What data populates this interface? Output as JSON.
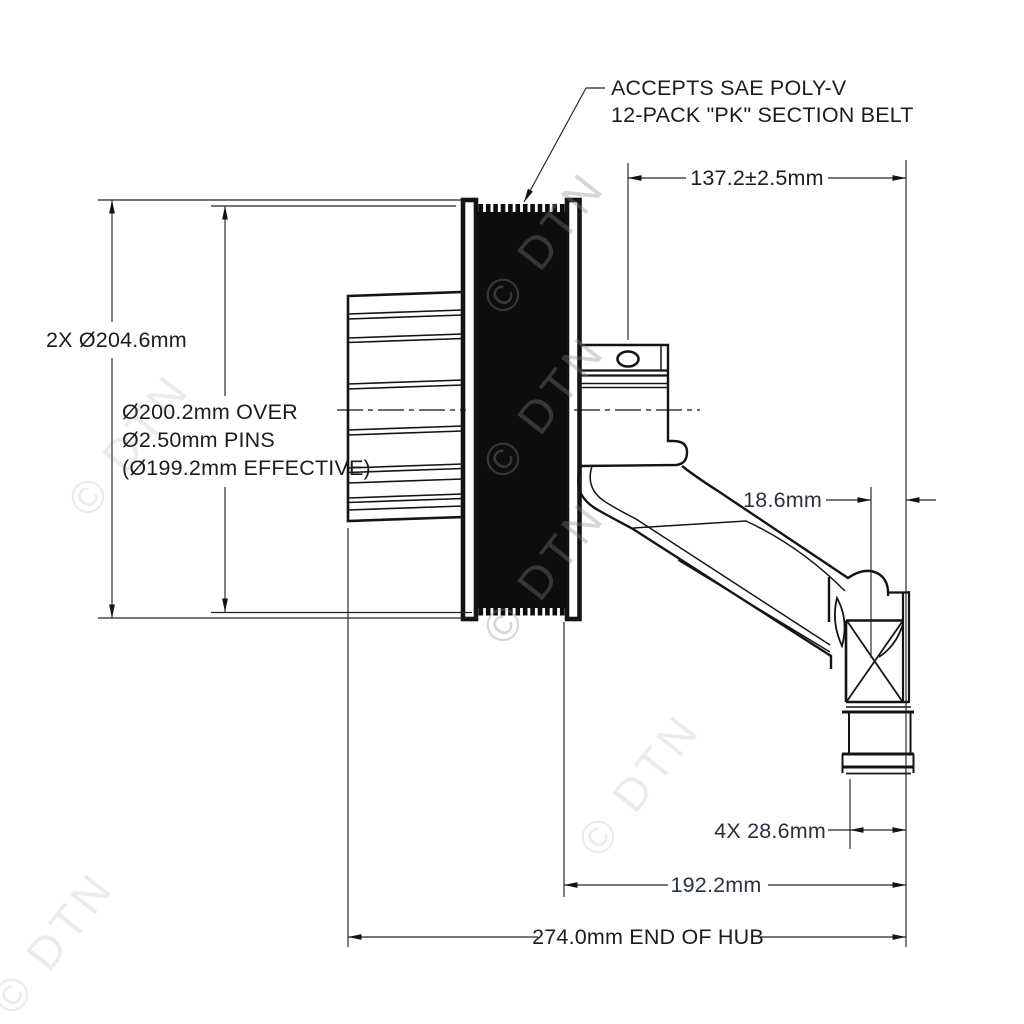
{
  "note": {
    "line1": "ACCEPTS SAE POLY-V",
    "line2": "12-PACK \"PK\" SECTION BELT"
  },
  "dimensions": {
    "top_width": "137.2±2.5mm",
    "outer_diameter": "2X Ø204.6mm",
    "over_pins_line1": "Ø200.2mm OVER",
    "over_pins_line2": "Ø2.50mm PINS",
    "over_pins_line3": "(Ø199.2mm EFFECTIVE)",
    "hub_offset": "18.6mm",
    "bolt_depth": "4X 28.6mm",
    "hub_length": "192.2mm",
    "overall_length": "274.0mm END OF HUB"
  },
  "watermark": {
    "text": "© DTN"
  },
  "colors": {
    "line": "#141414",
    "dimension_text": "#1c1c1c",
    "watermark": "#8a8a8a",
    "background": "#ffffff"
  }
}
